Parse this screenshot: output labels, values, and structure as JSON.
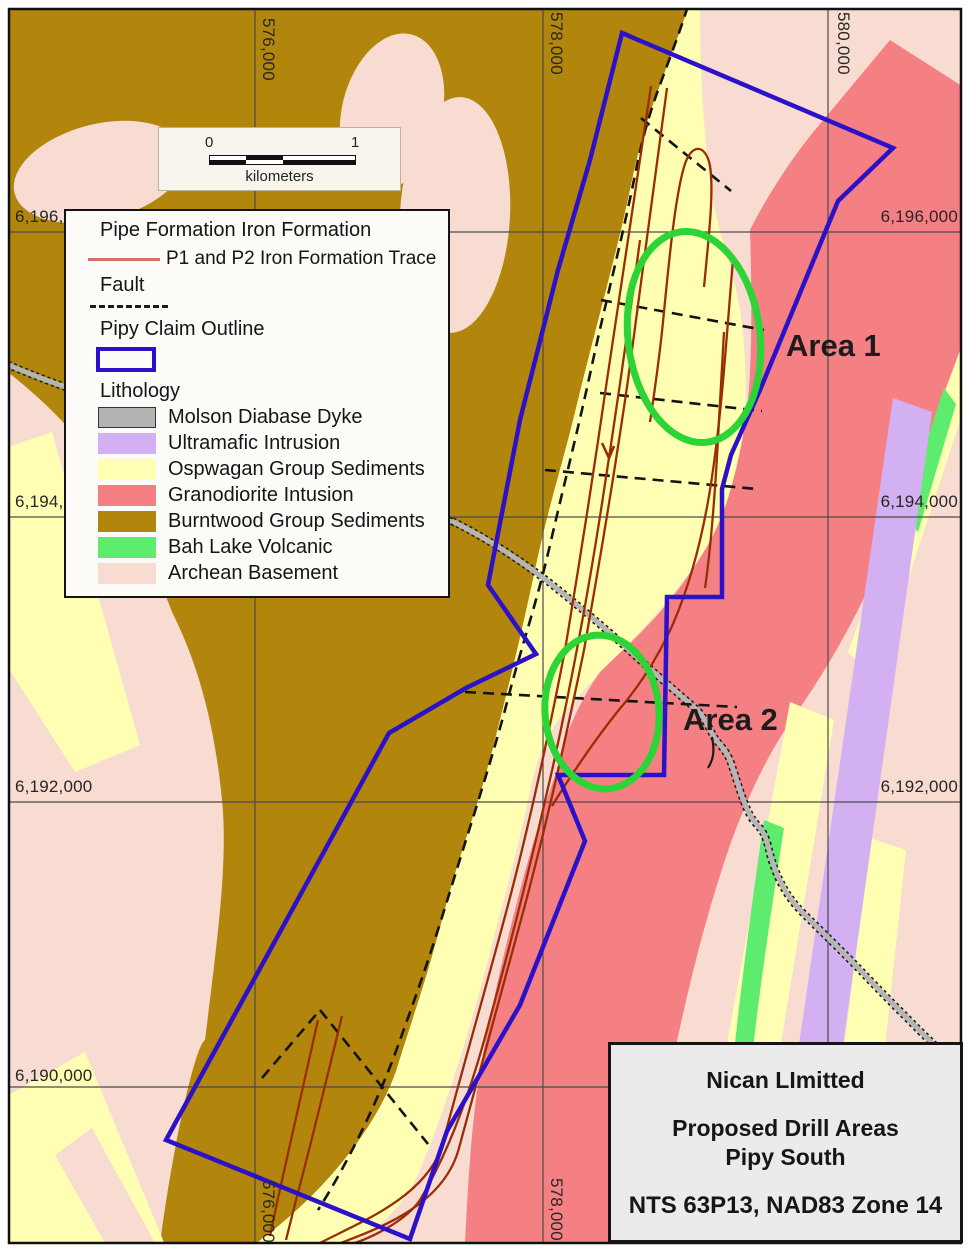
{
  "map": {
    "grid": {
      "top": [
        "576,000",
        "578,000",
        "580,000"
      ],
      "bottom": [
        "576,000",
        "578,000"
      ],
      "left": [
        "6,196,000",
        "6,194,000",
        "6,192,000",
        "6,190,000"
      ],
      "right": [
        "6,196,000",
        "6,194,000",
        "6,192,000"
      ]
    },
    "areas": [
      {
        "label": "Area 1"
      },
      {
        "label": "Area 2"
      }
    ]
  },
  "scale_bar": {
    "zero": "0",
    "one": "1",
    "units": "kilometers"
  },
  "legend": {
    "iron_formation_title": "Pipe Formation Iron Formation",
    "iron_formation_trace_label": "P1 and P2 Iron Formation Trace",
    "fault_label": "Fault",
    "claim_outline_label": "Pipy Claim Outline",
    "lithology_title": "Lithology",
    "lithology_items": [
      {
        "label": "Molson Diabase Dyke",
        "color": "#b3b3b3"
      },
      {
        "label": "Ultramafic Intrusion",
        "color": "#d3b0f2"
      },
      {
        "label": "Ospwagan Group Sediments",
        "color": "#ffffb4"
      },
      {
        "label": "Granodiorite Intusion",
        "color": "#f58084"
      },
      {
        "label": "Burntwood Group Sediments",
        "color": "#b2860d"
      },
      {
        "label": "Bah Lake Volcanic",
        "color": "#5dec6d"
      },
      {
        "label": "Archean Basement",
        "color": "#f8dcd2"
      }
    ]
  },
  "title_block": {
    "company": "Nican LImitted",
    "title_line1": "Proposed Drill Areas",
    "title_line2": "Pipy South",
    "reference": "NTS 63P13, NAD83 Zone 14"
  },
  "colors": {
    "archean_pink": "#f8dcd2",
    "burntwood_gold": "#b2860d",
    "ospwagan_yellow": "#ffffb4",
    "granodiorite_salmon": "#f58084",
    "ultramafic_purple": "#d3b0f2",
    "bah_lake_green": "#5dec6d",
    "molson_gray": "#b3b3b3",
    "road_gray": "#b5b5b5",
    "claim_blue": "#2b12c8",
    "trace_red": "#9b2d04",
    "legend_trace_red": "#d96c6c",
    "fault_black": "#141414",
    "drill_area_green": "#2cd435",
    "grid_gray": "#4a4a4a"
  }
}
